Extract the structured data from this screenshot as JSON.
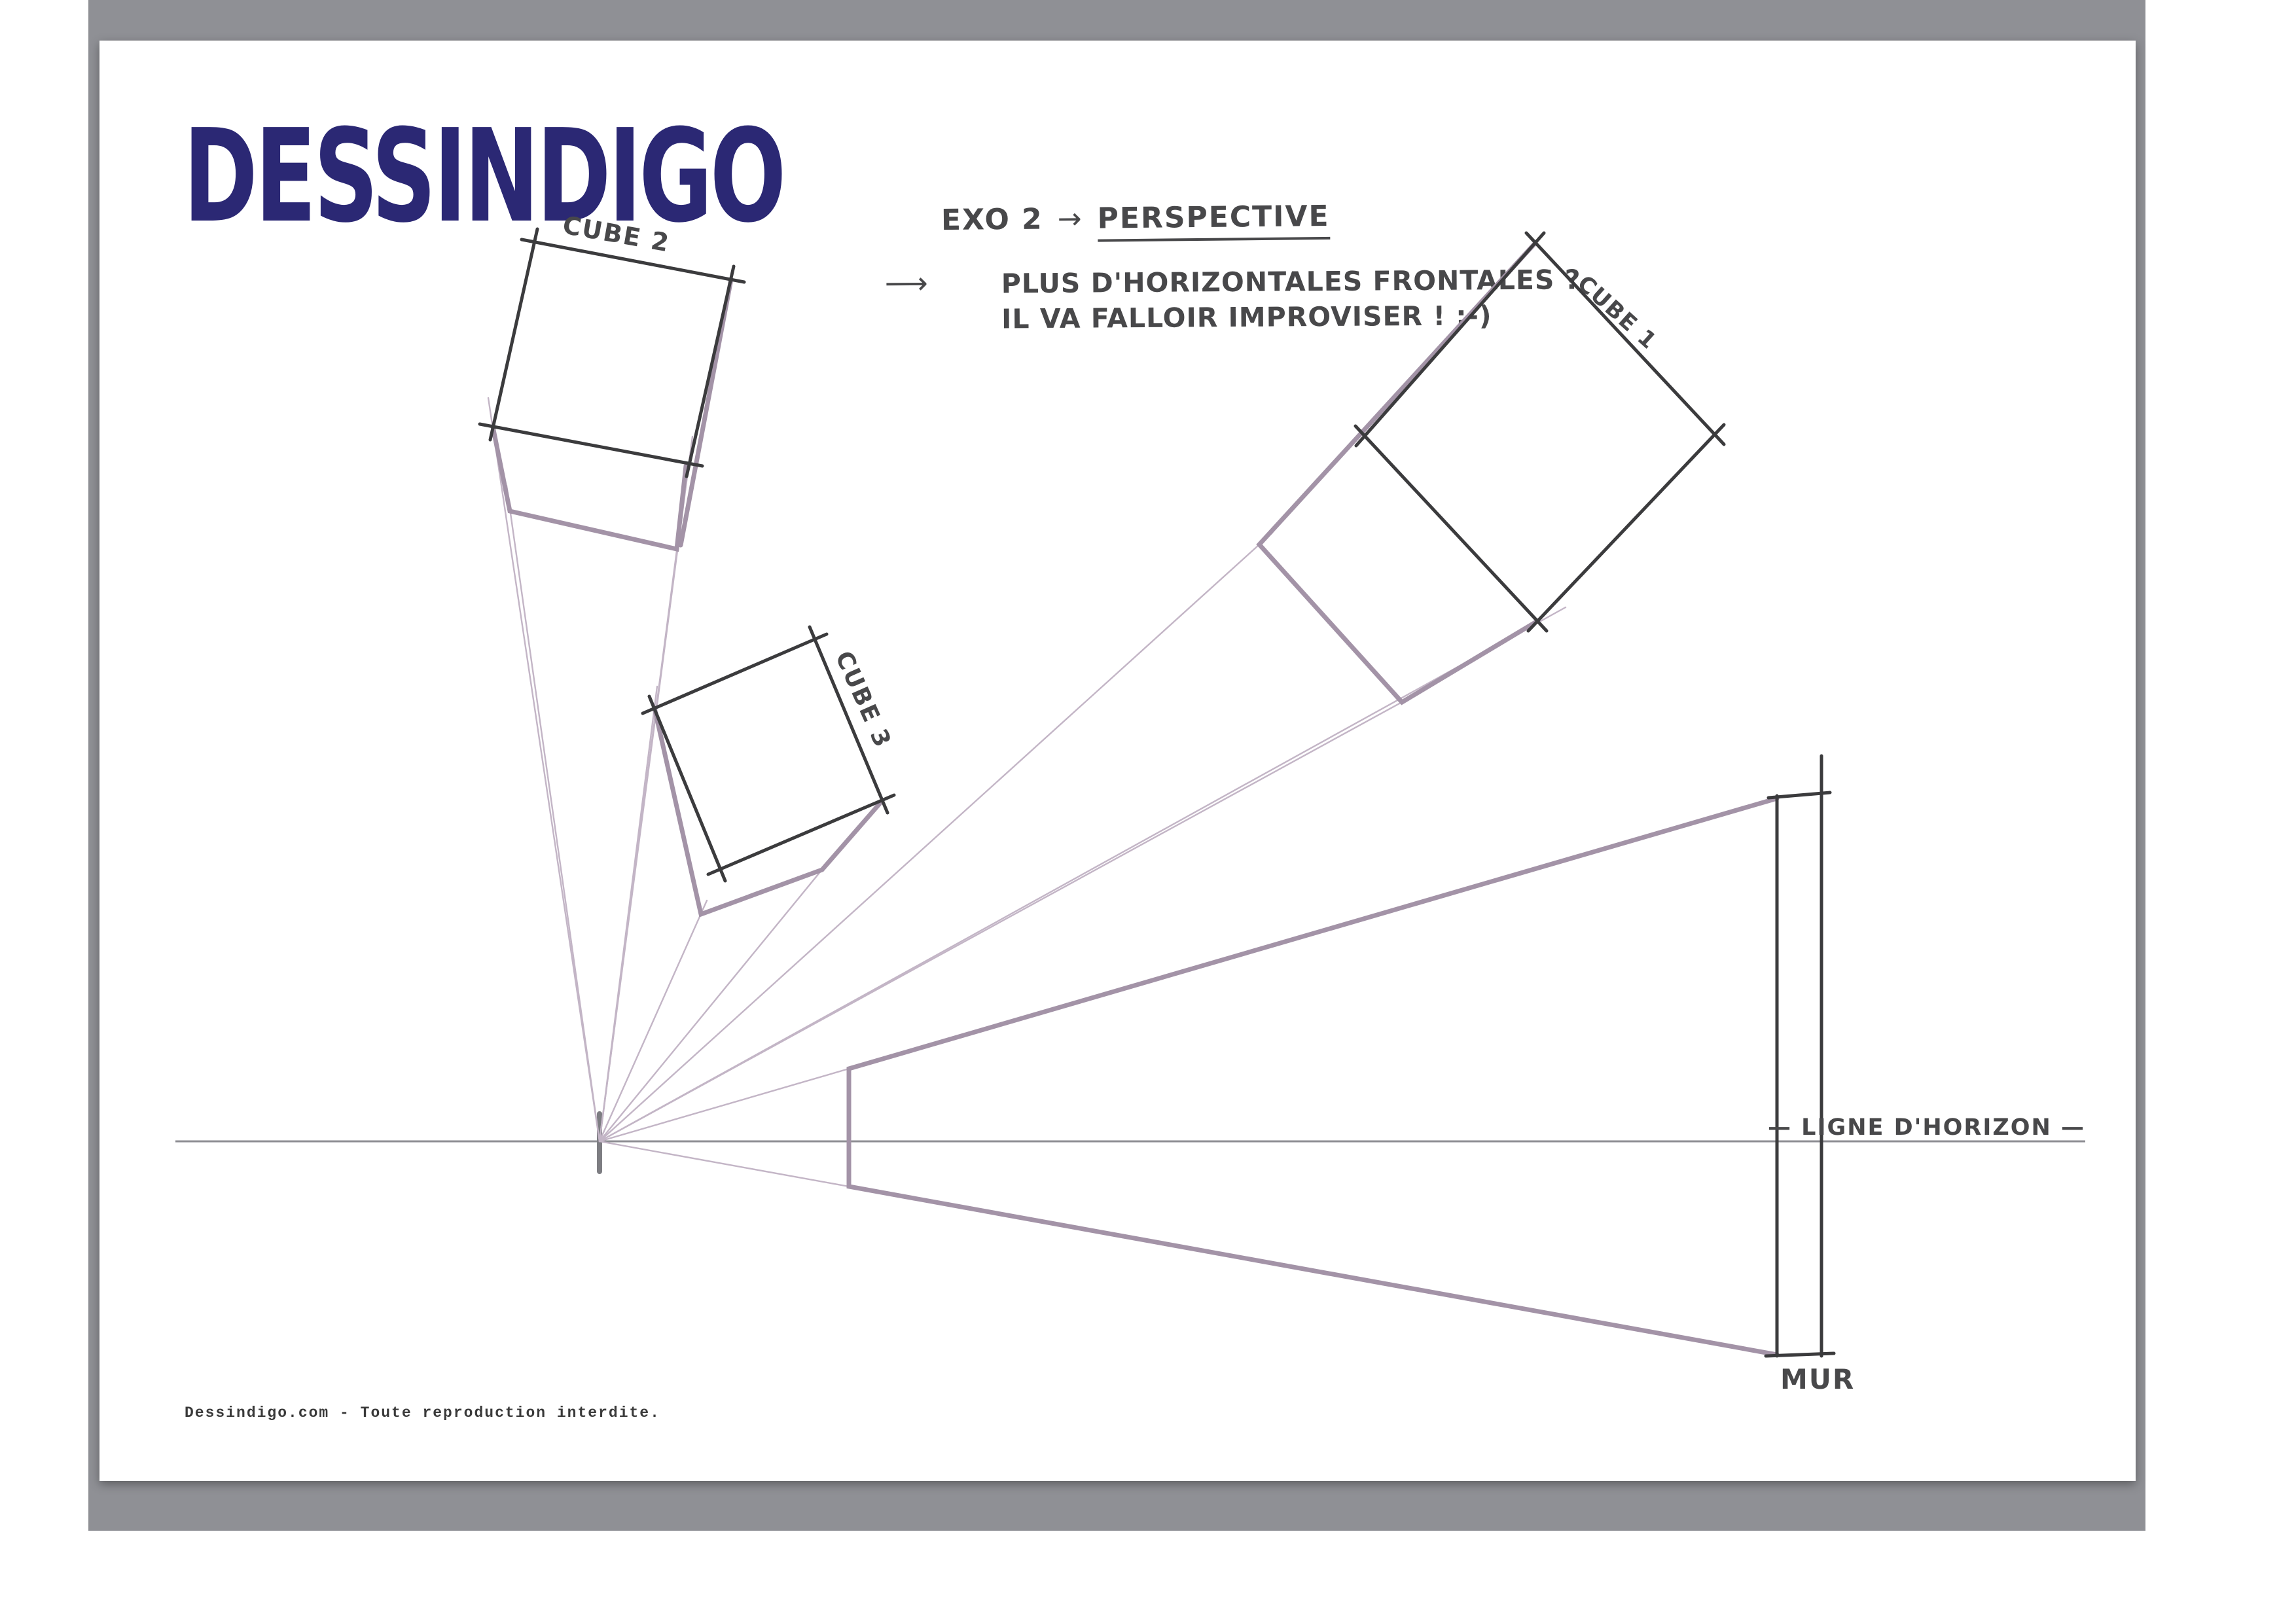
{
  "branding": {
    "logo_text": "DESSINDIGO"
  },
  "header_note": {
    "exercise": "EXO 2",
    "arrow": "→",
    "title": "PERSPECTIVE"
  },
  "note": {
    "long_arrow": "⟶",
    "line1": "PLUS D'HORIZONTALES FRONTALES ?",
    "line2": "IL VA FALLOIR IMPROVISER !  ;-)"
  },
  "drawing_labels": {
    "cube1": "CUBE 1",
    "cube2": "CUBE 2",
    "cube3": "CUBE 3",
    "wall": "MUR",
    "horizon": "— LIGNE D'HORIZON —"
  },
  "footer": {
    "text": "Dessindigo.com - Toute reproduction interdite."
  },
  "colors": {
    "logo_color": "#2b2874",
    "sketch_black": "#3b3b3d",
    "construction_purple": "#a393a7",
    "construction_thin": "#c3b5c6",
    "horizon_gray": "#8e8e93",
    "handwriting": "#48484a",
    "canvas_color": "#8f9095"
  }
}
